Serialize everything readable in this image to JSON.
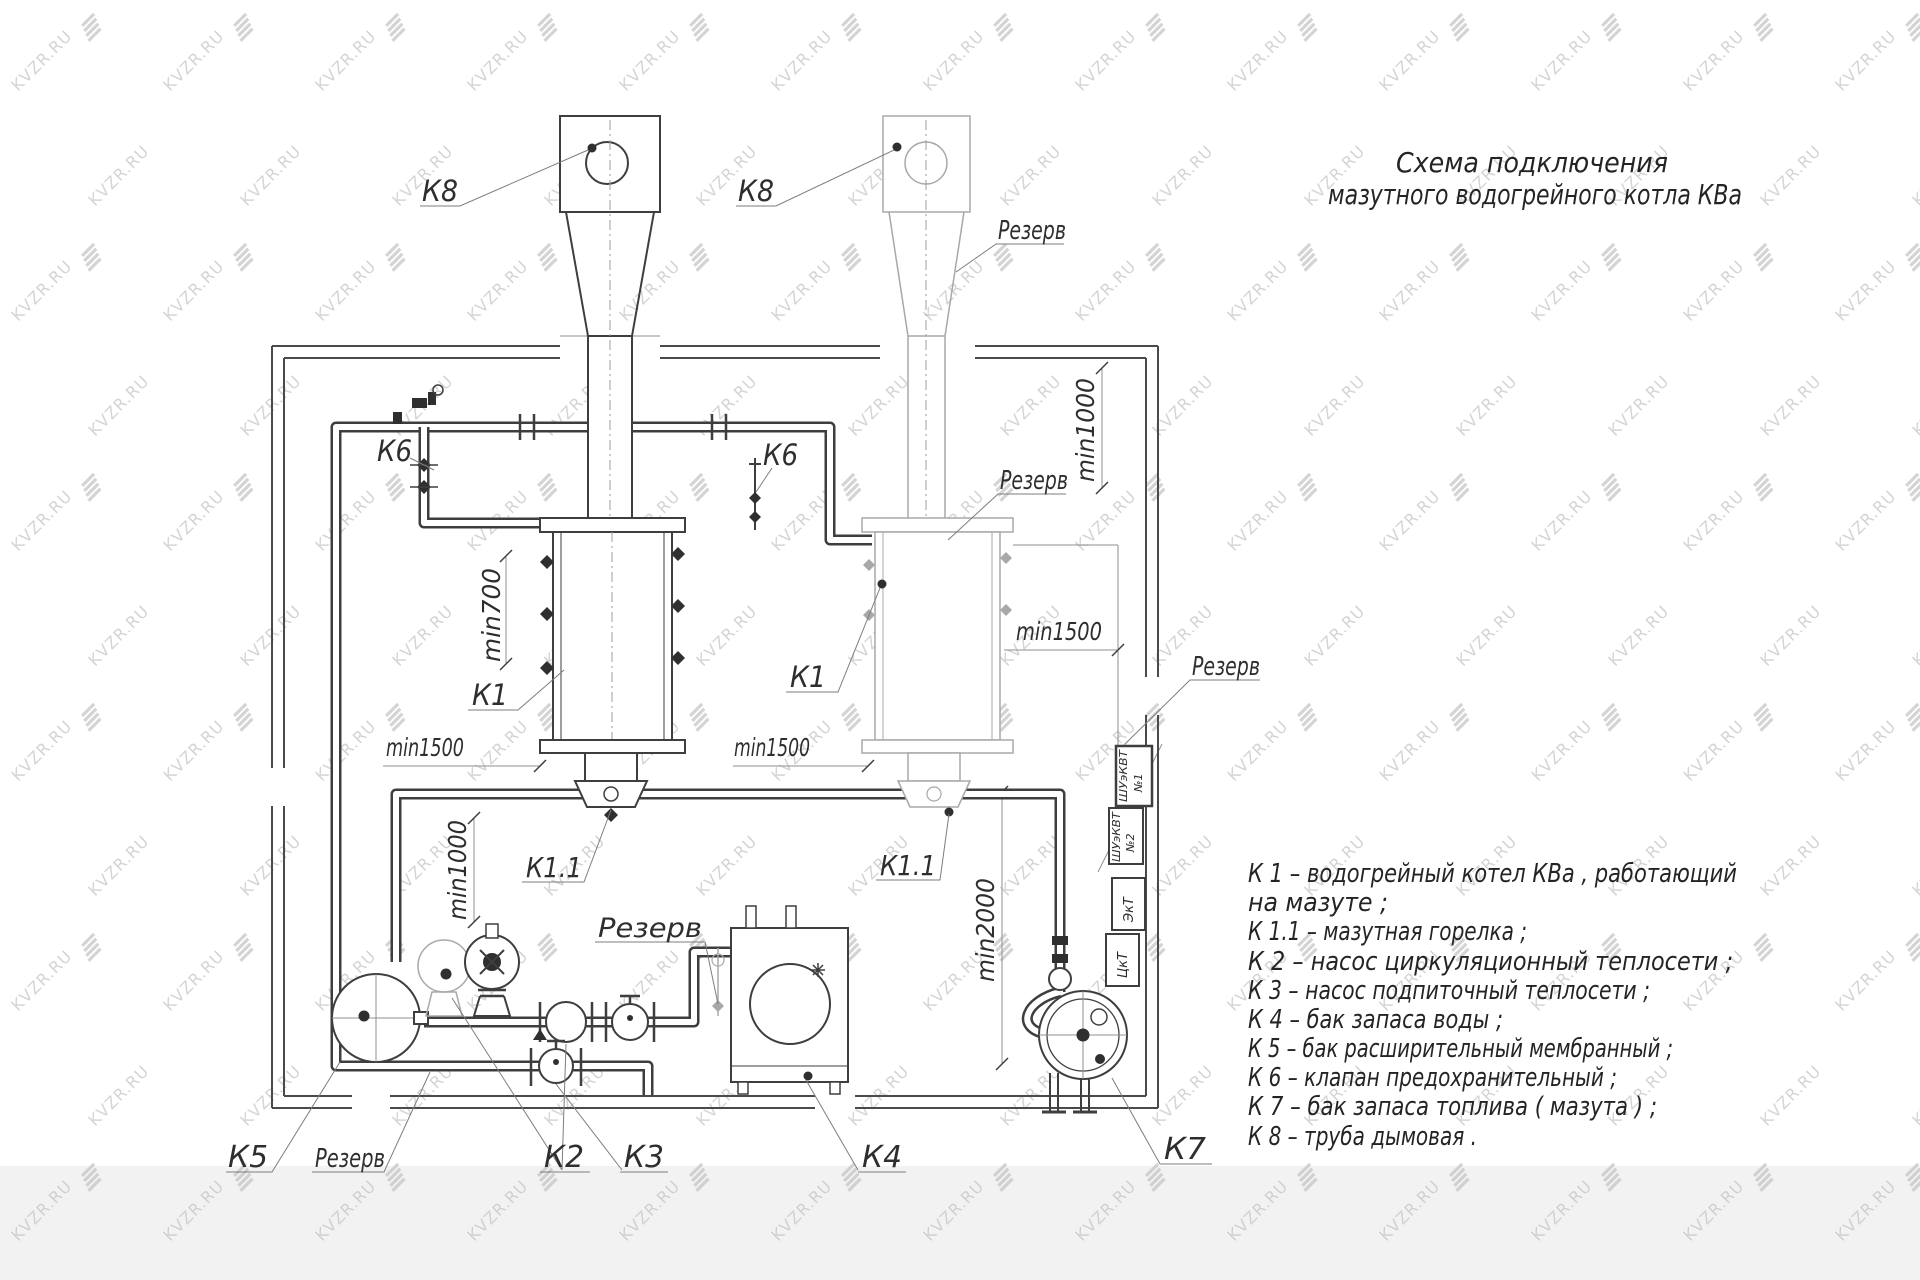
{
  "watermark": {
    "text": "KVZR.RU"
  },
  "title": {
    "line1": "Схема подключения",
    "line2": "мазутного водогрейного котла КВа"
  },
  "labels": {
    "k8_left": "К8",
    "k8_right": "К8",
    "k6_left": "К6",
    "k6_right": "К6",
    "k1_left": "К1",
    "k1_right": "К1",
    "k11_left": "К1.1",
    "k11_right": "К1.1",
    "k2": "К2",
    "k3": "К3",
    "k4": "К4",
    "k5": "К5",
    "k7": "К7",
    "reserve_top": "Резерв",
    "reserve_upper": "Резерв",
    "reserve_right": "Резерв",
    "reserve_center": "Резерв",
    "reserve_bottom_left": "Резерв",
    "min700": "min700",
    "min1000_left": "min1000",
    "min1000_right": "min1000",
    "min1500_left": "min1500",
    "min1500_center": "min1500",
    "min1500_right": "min1500",
    "min2000": "min2000"
  },
  "cabinets": {
    "c1_line1": "ШУэКВТ",
    "c1_line2": "№1",
    "c2_line1": "ШУэКВТ",
    "c2_line2": "№2",
    "box3": "ЭкТ",
    "box4": "ЦкТ"
  },
  "legend": {
    "lines": [
      "К 1 –  водогрейный котел КВа , работающий",
      "на мазуте ;",
      "К 1.1 –  мазутная горелка ;",
      "К 2 –  насос циркуляционный теплосети ;",
      "К 3 –  насос подпиточный теплосети ;",
      "К 4 –  бак запаса воды ;",
      "К 5 –  бак расширительный мембранный ;",
      "К 6 –  клапан предохранительный ;",
      "К 7 –  бак запаса топлива ( мазута ) ;",
      "К 8 –  труба дымовая ."
    ]
  }
}
